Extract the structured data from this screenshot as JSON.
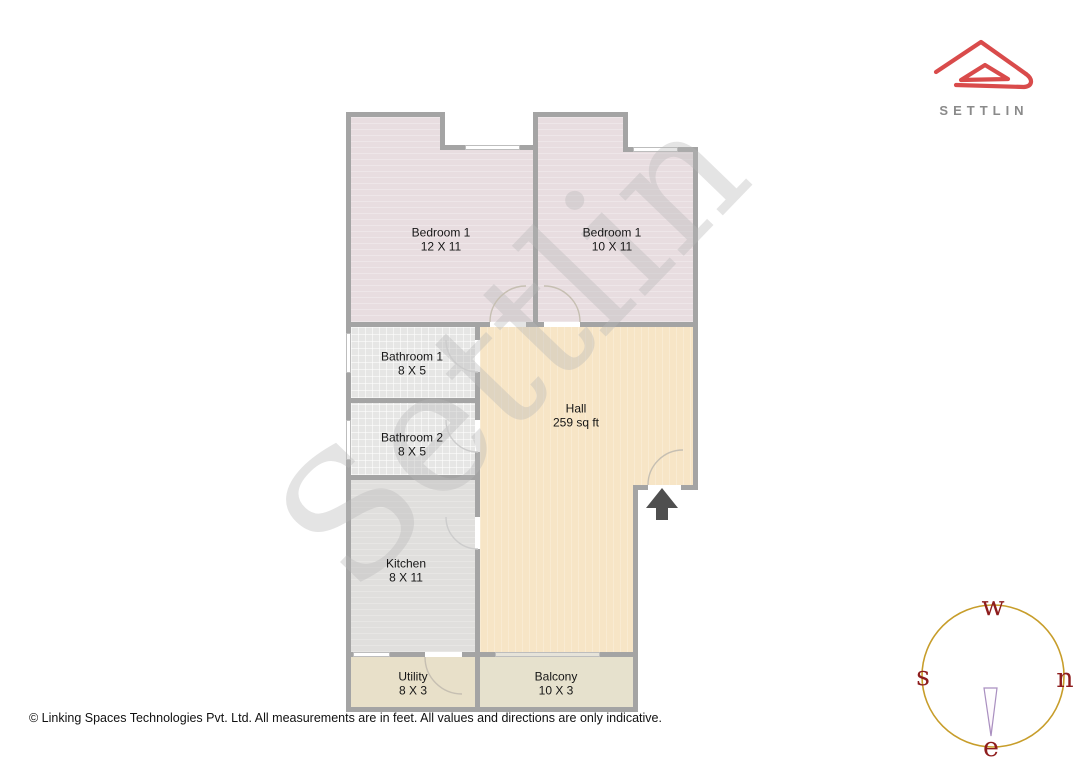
{
  "brand": {
    "logo_text": "SETTLIN",
    "logo_color": "#d94b4b",
    "logo_text_color": "#8a8a8a"
  },
  "watermark": {
    "text": "Settlin"
  },
  "plan": {
    "rooms": [
      {
        "id": "bedroom-left",
        "name": "Bedroom 1",
        "dims": "12 X 11"
      },
      {
        "id": "bedroom-right",
        "name": "Bedroom 1",
        "dims": "10 X 11"
      },
      {
        "id": "bathroom-1",
        "name": "Bathroom 1",
        "dims": "8 X 5"
      },
      {
        "id": "bathroom-2",
        "name": "Bathroom 2",
        "dims": "8 X 5"
      },
      {
        "id": "hall",
        "name": "Hall",
        "dims": "259 sq ft"
      },
      {
        "id": "kitchen",
        "name": "Kitchen",
        "dims": "8 X 11"
      },
      {
        "id": "utility",
        "name": "Utility",
        "dims": "8 X 3"
      },
      {
        "id": "balcony",
        "name": "Balcony",
        "dims": "10 X 3"
      }
    ],
    "wall_color": "#a4a4a4",
    "hall_color": "#f7e5c6",
    "bedroom_color": "#e8dde0",
    "entrance_arrow_color": "#4f4f4f"
  },
  "compass": {
    "top": "w",
    "left": "s",
    "right": "n",
    "bottom": "e",
    "circle_color": "#c79d2a",
    "letter_color": "#8e1d1d"
  },
  "footer": {
    "text": "© Linking Spaces Technologies Pvt. Ltd. All measurements are in feet. All values and directions are only indicative."
  }
}
